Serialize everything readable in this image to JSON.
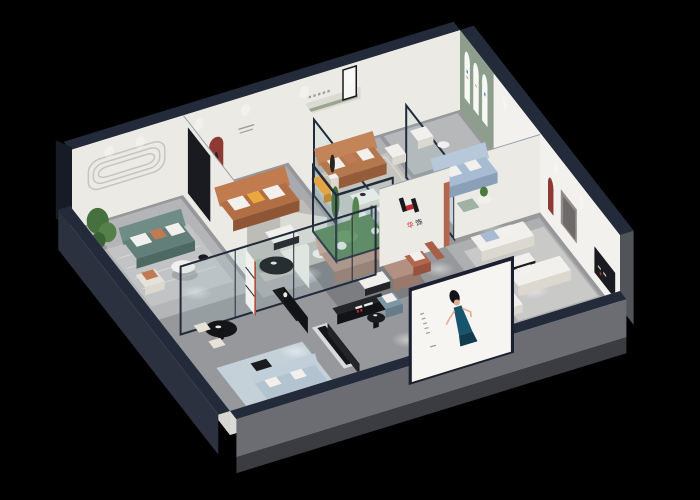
{
  "scene": {
    "description": "isometric 3d cutaway floor plan render of a furniture showroom on a black background",
    "background": "#000000"
  },
  "brand": {
    "logo_letter": "H",
    "logo_char1": "华",
    "logo_char2": "饰",
    "logo_red": "#c3272f",
    "logo_dark": "#1a1a1e",
    "wall_logo": "brand H logo with chinese characters on white partition wall",
    "tv_logo": "brand logo graphics on black media console"
  },
  "poster": {
    "name": "fashion-model-billboard",
    "panel": "#f6f5f2",
    "dress": "#19546d",
    "dressDark": "#123c4e",
    "hair": "#141316",
    "skin": "#e0ad92",
    "caption": "vertical text column"
  },
  "rooms": [
    {
      "name": "teal-sofa-lounge",
      "accent": "#628079",
      "items": [
        "teal-fabric-sofa",
        "round-coffee-table",
        "beige-armchair",
        "potted-plant",
        "striped-rug",
        "rounded-lines-wall-relief"
      ]
    },
    {
      "name": "tan-leather-lounge",
      "accent": "#b26f45",
      "items": [
        "leather-sofa",
        "white-coffee-table",
        "red-arch-niche",
        "wall-slogan"
      ]
    },
    {
      "name": "caramel-sofa-display",
      "accent": "#b5774d",
      "items": [
        "caramel-sofa",
        "orange-chaise",
        "white-dining-table",
        "statue-pedestal",
        "wall-niche-green-strip",
        "framed-mirror"
      ]
    },
    {
      "name": "arch-gallery",
      "accent": "#8d9e8c",
      "items": [
        "sage-green-wall",
        "three-arched-panels",
        "white-armchair",
        "side-table"
      ]
    },
    {
      "name": "blue-sofa-room",
      "accent": "#a7bcd2",
      "items": [
        "light-blue-sofa",
        "sage-armchair",
        "round-side-table",
        "glass-partition"
      ]
    },
    {
      "name": "white-sofa-room",
      "accent": "#eae9e5",
      "items": [
        "white-sofa-pair",
        "coffee-table",
        "red-arch-niche",
        "wall-panel",
        "black-display-rack"
      ]
    },
    {
      "name": "central-lounge",
      "accent": "#b29082",
      "items": [
        "curved-white-partition",
        "black-oval-table",
        "mint-curved-sofa",
        "taupe-sectional-sofa",
        "white-coffee-table"
      ]
    },
    {
      "name": "atrium-garden",
      "accent": "#4e7a44",
      "items": [
        "glass-enclosure",
        "cacti",
        "white-hydrangeas"
      ]
    },
    {
      "name": "front-gallery",
      "accent": "#7e97a5",
      "items": [
        "black-oval-dining-table",
        "cream-chairs",
        "red-display-shelf",
        "black-sideboard",
        "media-console-with-logo",
        "slate-armchairs",
        "ottoman",
        "black-pedestal-table",
        "white-bed",
        "round-black-rug",
        "light-blue-sofa",
        "metal-bench"
      ]
    }
  ],
  "palette": {
    "bg": "#000000",
    "navy": "#232b3b",
    "navyDeep": "#1a202e",
    "navyCol": "#161b26",
    "wallWhite": "#eceae5",
    "wallBright": "#f2f1ee",
    "wallShade": "#dcdad4",
    "wallInner": "#d7d5d0",
    "plinthGray": "#6b6d72",
    "plinthDark": "#3a3c41",
    "outerNavy": "#2c3140",
    "outerGray": "#515459",
    "windowSlit": "#23252a",
    "floorBase": "#97989b",
    "floorLight": "#b4b5b7",
    "floorMid": "#a9aaad",
    "floorTop": "#b0b1b3",
    "floorArch": "#b7b8ba",
    "floorRight": "#aeafb1",
    "rugGray": "#c2c3c5",
    "rugTan": "#bebcb6",
    "rugCaramel": "#c6c4bf",
    "rugBlue": "#ccd5dd",
    "rugRight": "#c9c9c7",
    "rugDark": "#7c7d80",
    "rugWalk": "#c4d1d9",
    "teal": "#628079",
    "tealDark": "#4e6862",
    "tealLight": "#6f8d86",
    "leather": "#b26f45",
    "leatherDark": "#8e5634",
    "leatherLight": "#c07c4f",
    "caramel": "#b5774d",
    "caramelDark": "#955c39",
    "caramelLight": "#c3845a",
    "mauve": "#b29082",
    "mauveDark": "#99796b",
    "mauveLight": "#c4a696",
    "blueSofa": "#a7bcd2",
    "blueSofaDark": "#8aa0b8",
    "blueSofaLight": "#b6c8da",
    "slate": "#7e97a5",
    "slateDark": "#667c8c",
    "frontBlue": "#b3c3cf",
    "frontBlueDark": "#97a9b7",
    "frontBlueLight": "#c0cfda",
    "sageWall": "#8d9e8c",
    "sagePanel": "#f7f7f4",
    "sageChair": "#9fb2a4",
    "sageStrip": "#98a68e",
    "white": "#f1f0ec",
    "whiteDim": "#dcd8cf",
    "cream": "#e7e2d8",
    "orange": "#ef9f2e",
    "orangeDark": "#c77f1d",
    "cushionOrange": "#e9a93e",
    "terracotta": "#c27a55",
    "rust": "#b2664d",
    "rustDark": "#96523c",
    "rustDeep": "#a85f47",
    "redNiche": "#8e3a33",
    "crimson": "#a8402f",
    "black": "#17181c",
    "blackSoft": "#1a1b1f",
    "blackPanel": "#191b20",
    "blackTable": "#141518",
    "console": "#232528",
    "consoleDark": "#121316",
    "silver": "#d9dadc",
    "silverDark": "#222428",
    "grayPanel": "#8f8c88",
    "grayPanelIn": "#6e6a6c",
    "green1": "#47703f",
    "green2": "#558049",
    "green3": "#3c6136",
    "atriumFloor": "#4e7a44",
    "atriumMoss": "#5d8c4e",
    "cactus1": "#3f6b33",
    "cactus2": "#4a7a3c",
    "cactus3": "#577f43",
    "flower": "#e9eae4",
    "pot": "#9b9893",
    "statue": "#2a241f",
    "pedestal": "#efeeea",
    "markGray": "#a09d96",
    "blueLogo": "#3a7ca8"
  }
}
